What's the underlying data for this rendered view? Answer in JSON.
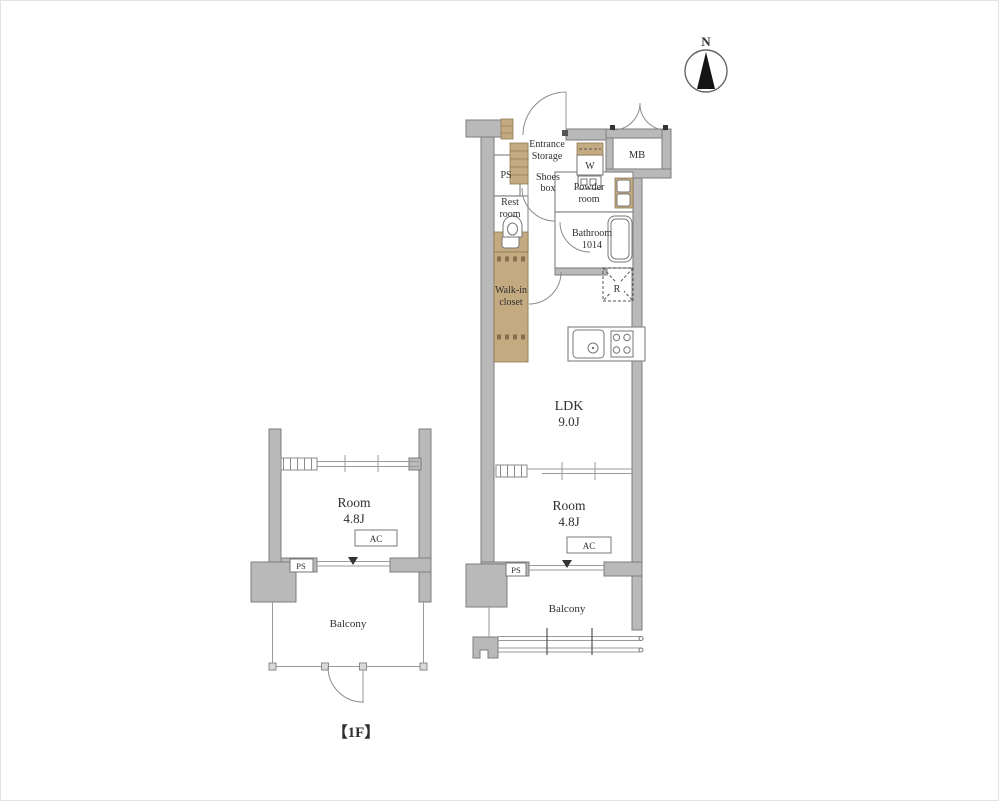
{
  "compass": {
    "north": "N"
  },
  "right_unit": {
    "entrance_storage_line1": "Entrance",
    "entrance_storage_line2": "Storage",
    "ps_upper": "PS",
    "shoes_line1": "Shoes",
    "shoes_line2": "box",
    "washer": "W",
    "meter_box": "MB",
    "powder_line1": "Powder",
    "powder_line2": "room",
    "rest_line1": "Rest",
    "rest_line2": "room",
    "bath_line1": "Bathroom",
    "bath_line2": "1014",
    "walkin_line1": "Walk-in",
    "walkin_line2": "closet",
    "refrigerator": "R",
    "ldk_name": "LDK",
    "ldk_size": "9.0J",
    "room_name": "Room",
    "room_size": "4.8J",
    "ac": "AC",
    "ps_lower": "PS",
    "balcony": "Balcony"
  },
  "left_unit": {
    "room_name": "Room",
    "room_size": "4.8J",
    "ac": "AC",
    "ps": "PS",
    "balcony": "Balcony"
  },
  "floor_label": "【1F】",
  "colors": {
    "wall": "#b9b9b9",
    "closet": "#c3aa80",
    "line": "#8a8a8a"
  }
}
